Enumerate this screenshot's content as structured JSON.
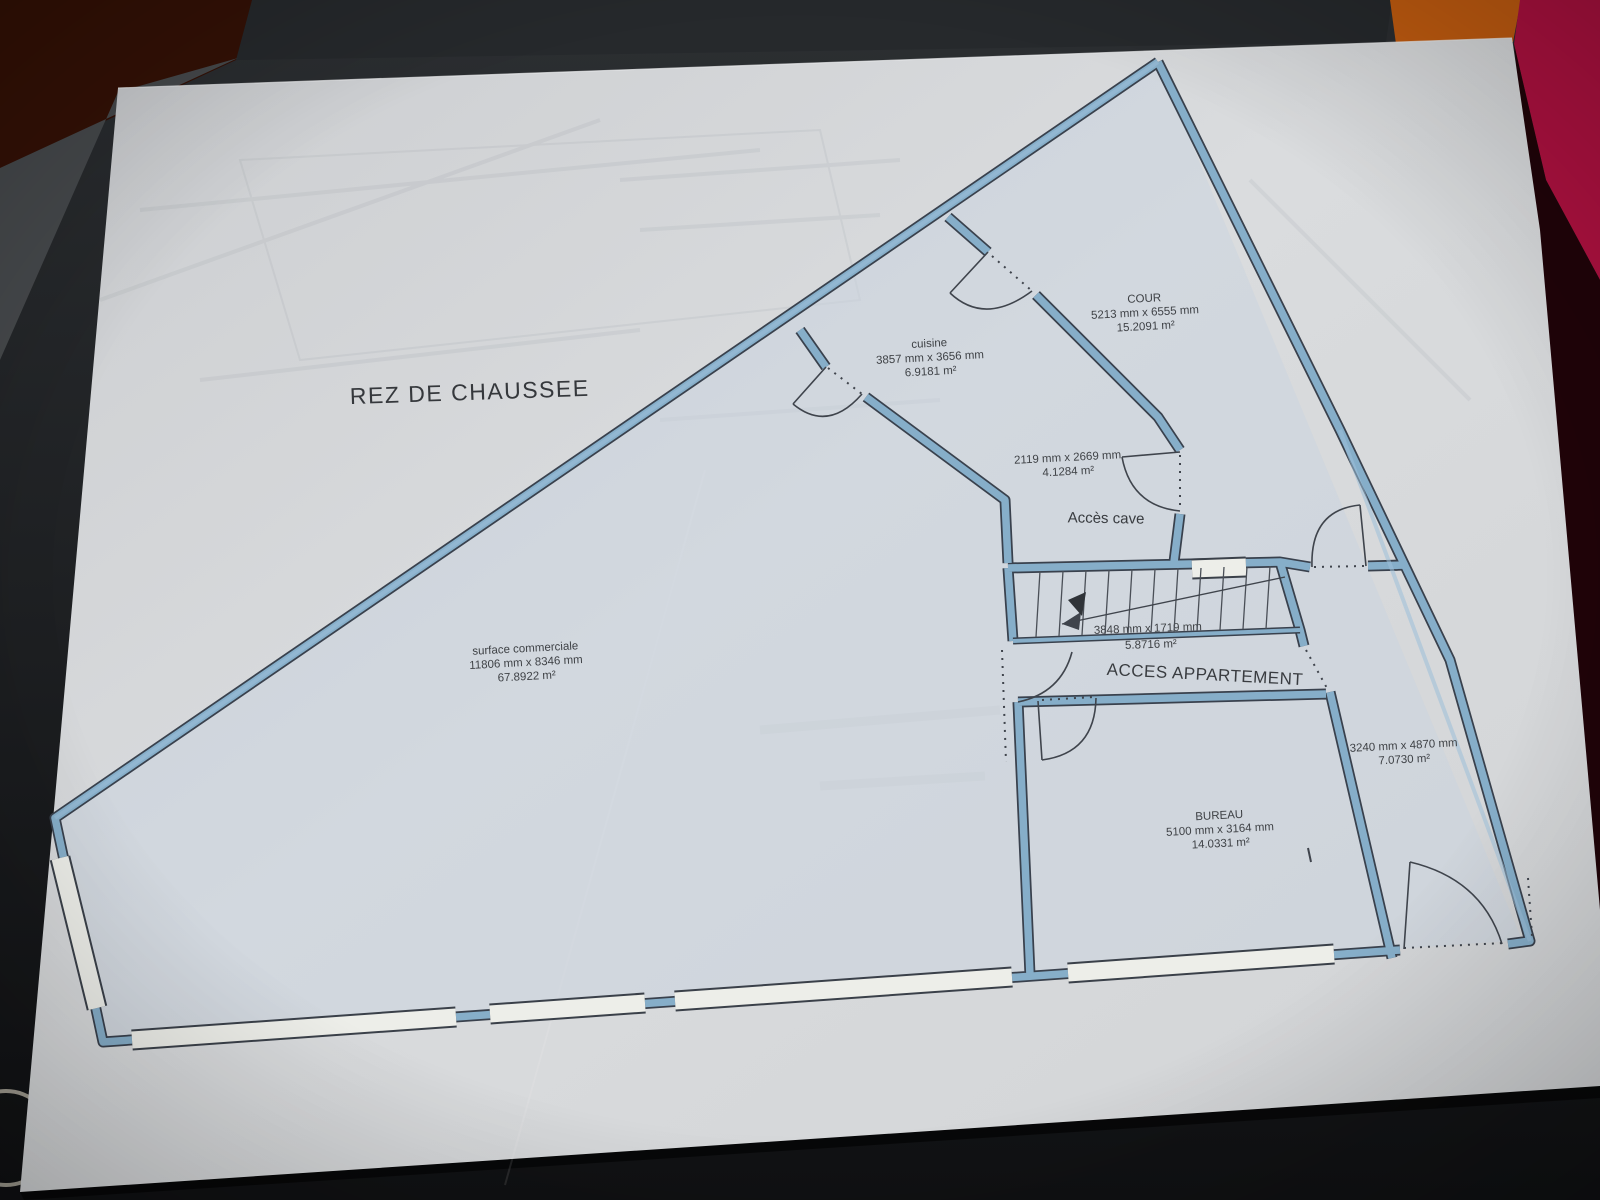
{
  "photo": {
    "paper_color": "#d7d9db",
    "table_color": "#1c1e20",
    "objects": {
      "maroon": "#341106",
      "orange": "#c25c10",
      "crimson": "#ae1140"
    }
  },
  "plan": {
    "title": "REZ DE CHAUSSEE",
    "colors": {
      "wall": "#86aec9",
      "wall_edge": "#39414d",
      "window": "#edeee9",
      "line": "#3f444c",
      "text": "#3f4246"
    },
    "rooms": [
      {
        "name": "cuisine",
        "dims": "3857 mm x 3656 mm",
        "area": "6.9181 m²"
      },
      {
        "name": "COUR",
        "dims": "5213 mm x 6555 mm",
        "area": "15.2091 m²"
      },
      {
        "name": "",
        "dims": "2119 mm x 2669 mm",
        "area": "4.1284 m²"
      },
      {
        "name": "surface commerciale",
        "dims": "11806 mm x 8346 mm",
        "area": "67.8922 m²"
      },
      {
        "name": "",
        "dims": "3848 mm x 1719 mm",
        "area": "5.8716 m²"
      },
      {
        "name": "",
        "dims": "3240 mm x 4870 mm",
        "area": "7.0730 m²"
      },
      {
        "name": "BUREAU",
        "dims": "5100 mm x 3164 mm",
        "area": "14.0331 m²"
      }
    ],
    "annotations": [
      {
        "label": "Accès cave"
      },
      {
        "label": "ACCES APPARTEMENT"
      }
    ]
  }
}
